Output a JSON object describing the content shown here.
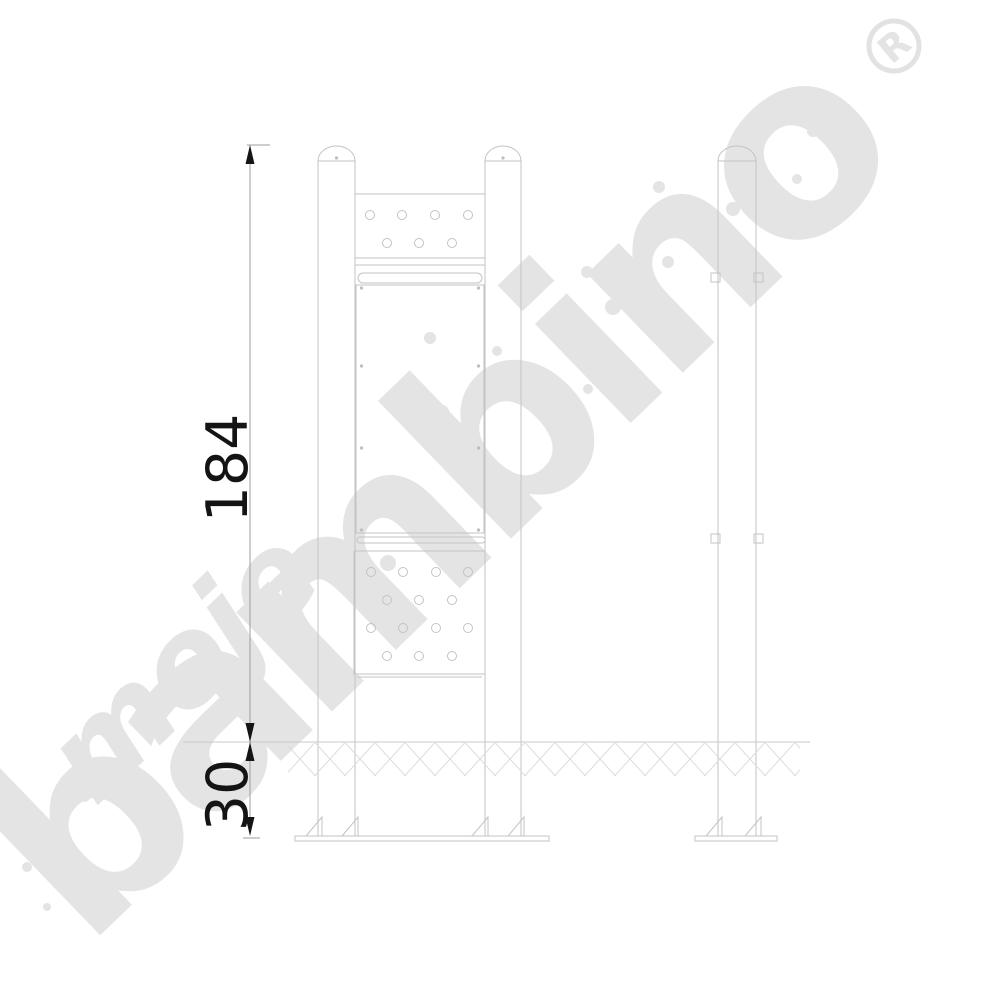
{
  "page": {
    "background_color": "#ffffff",
    "type": "technical dimension drawing"
  },
  "watermark": {
    "brand_prefix": "moje",
    "brand_word": "bambino",
    "registered_mark": "R",
    "color": "#e4e4e4"
  },
  "dimensions": {
    "height_label": "184",
    "depth_label": "30"
  },
  "drawing": {
    "line_color": "#c3c3c3",
    "dimension_color": "#141414",
    "parts": {
      "posts": 3,
      "panels": 3,
      "ground_hatch": true,
      "base_plates": 2
    }
  }
}
